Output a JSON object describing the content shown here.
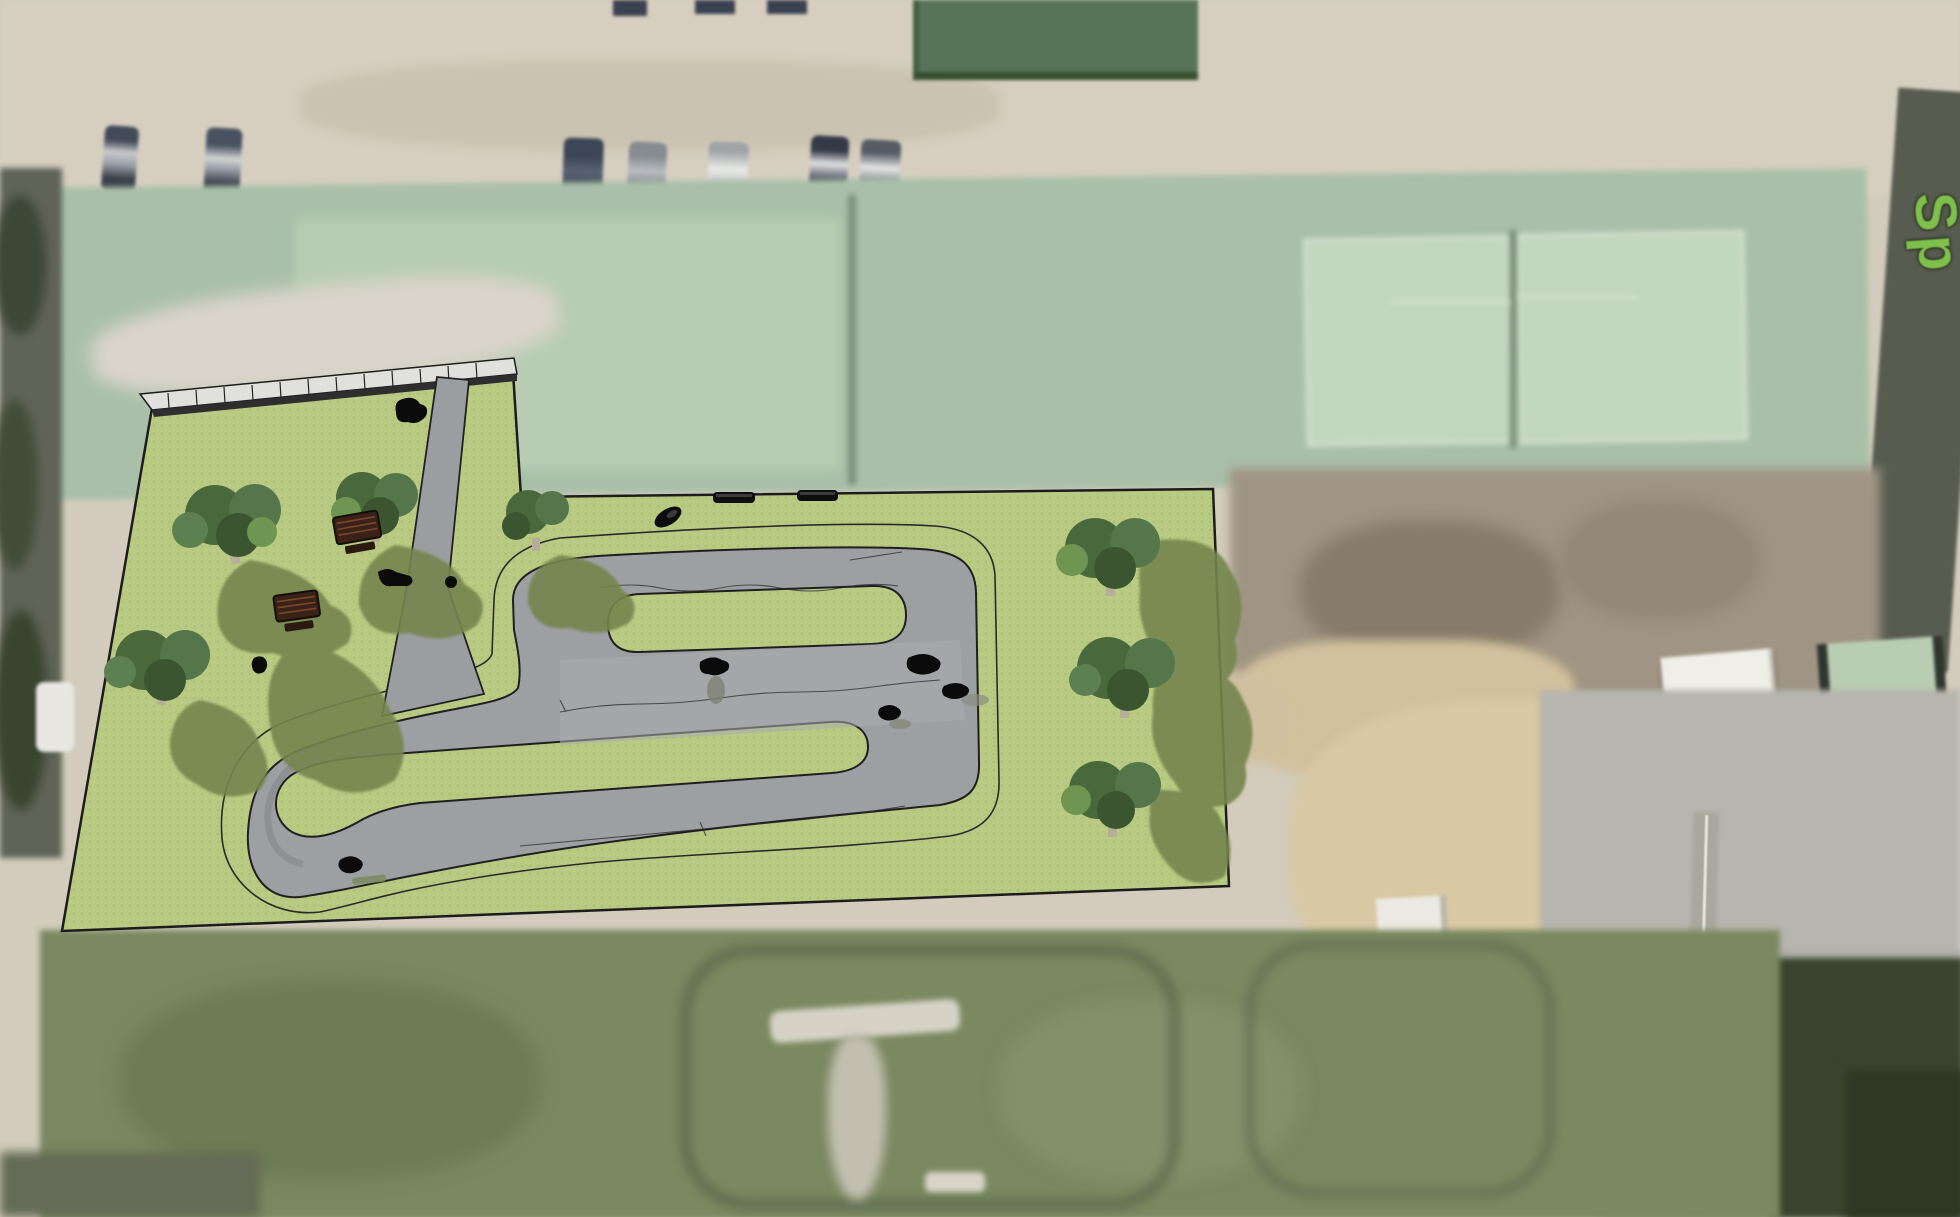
{
  "meta": {
    "view": "aerial satellite photograph with architectural concept overlay",
    "subject": "pump-track / bike park site plan rendered over sports complex aerial",
    "canvas": {
      "width": 1960,
      "height": 1217
    }
  },
  "map_label": {
    "text": "Sp",
    "note": "partially visible green street/park map label, rotated, clipped at right edge",
    "color": "#7fbf4b"
  },
  "colors": {
    "grass": "#b8ca82",
    "grass_dot": "#aabe74",
    "track": "#9da0a3",
    "ink": "#1f1f1f",
    "sat_beige": "#d3ccbc",
    "sat_tennis": "#a9bfa9",
    "sat_field": "#79875e",
    "label_green": "#7fbf4b",
    "tree_foliage": "#49683c",
    "tree_shadow": "#75854e",
    "picnic_table_brown": "#4a2c1e"
  },
  "overlay": {
    "name": "pump-track-concept-overlay",
    "elements": {
      "ground": "textured lawn polygon",
      "track": "grey serpentine pump-track loop with two green infield islands and a left hairpin",
      "walkway": "diagonal access path from fenced corner to track",
      "fence": "post fence along upper-left boundary",
      "trees": 7,
      "picnic_tables": 2,
      "black_benches": 2,
      "riders_and_people": 9,
      "parked_vehicle": 1
    }
  },
  "background": {
    "areas": [
      {
        "name": "parking-lot",
        "desc": "beige lot with parked cars, top"
      },
      {
        "name": "dark-roof-building",
        "desc": "green flat roof, top centre"
      },
      {
        "name": "tennis-courts-west",
        "desc": "faded pair of courts"
      },
      {
        "name": "tennis-courts-east",
        "desc": "pair of courts with light markings"
      },
      {
        "name": "scrub-ground",
        "desc": "brown bare ground right of overlay"
      },
      {
        "name": "white-roof-building",
        "desc": "small hall, mid right"
      },
      {
        "name": "green-roof-court",
        "desc": "light green cage court, far right"
      },
      {
        "name": "sports-field",
        "desc": "large worn grass field, bottom"
      },
      {
        "name": "footpath",
        "desc": "vertical path with white edge line, bottom right"
      },
      {
        "name": "hedge",
        "desc": "dark vegetation, bottom right corner"
      },
      {
        "name": "street-west",
        "desc": "tree lined street strip, far left"
      }
    ],
    "cars_parked_top": 7
  }
}
